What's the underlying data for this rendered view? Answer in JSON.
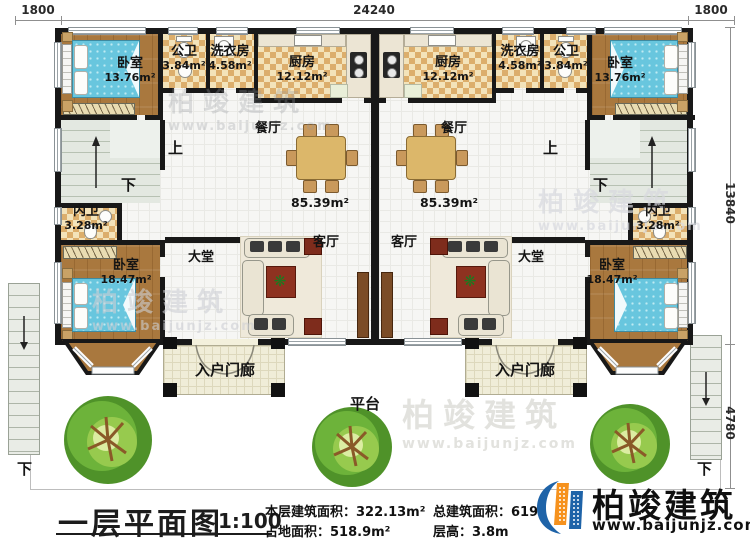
{
  "dimensions": {
    "top_left": "1800",
    "top_width": "24240",
    "top_right": "1800",
    "building_depth": "13840",
    "platform_depth": "4780"
  },
  "shared": {
    "up": "上",
    "down": "下",
    "platform": "平台"
  },
  "unit_left": {
    "bedroom_top": {
      "name": "卧室",
      "area": "13.76m²"
    },
    "public_bath": {
      "name": "公卫",
      "area": "3.84m²"
    },
    "laundry": {
      "name": "洗衣房",
      "area": "4.58m²"
    },
    "kitchen": {
      "name": "厨房",
      "area": "12.12m²"
    },
    "dining": "餐厅",
    "living": "客厅",
    "hall": "大堂",
    "floor_area": "85.39m²",
    "ensuite_bath": {
      "name": "内卫",
      "area": "3.28m²"
    },
    "bedroom_bottom": {
      "name": "卧室",
      "area": "18.47m²"
    },
    "porch": "入户门廊"
  },
  "unit_right": {
    "bedroom_top": {
      "name": "卧室",
      "area": "13.76m²"
    },
    "public_bath": {
      "name": "公卫",
      "area": "3.84m²"
    },
    "laundry": {
      "name": "洗衣房",
      "area": "4.58m²"
    },
    "kitchen": {
      "name": "厨房",
      "area": "12.12m²"
    },
    "dining": "餐厅",
    "living": "客厅",
    "hall": "大堂",
    "floor_area": "85.39m²",
    "ensuite_bath": {
      "name": "内卫",
      "area": "3.28m²"
    },
    "bedroom_bottom": {
      "name": "卧室",
      "area": "18.47m²"
    },
    "porch": "入户门廊"
  },
  "titleblock": {
    "title": "一层平面图",
    "scale": "1:100",
    "stats": [
      {
        "label": "本层建筑面积：",
        "value": "322.13m²"
      },
      {
        "label": "占地面积：",
        "value": "518.9m²"
      },
      {
        "label": "总建筑面积：",
        "value": "619"
      },
      {
        "label": "层高：",
        "value": "3.8m"
      }
    ]
  },
  "brand": {
    "name": "柏竣建筑",
    "url": "www.baijunjz.com"
  }
}
